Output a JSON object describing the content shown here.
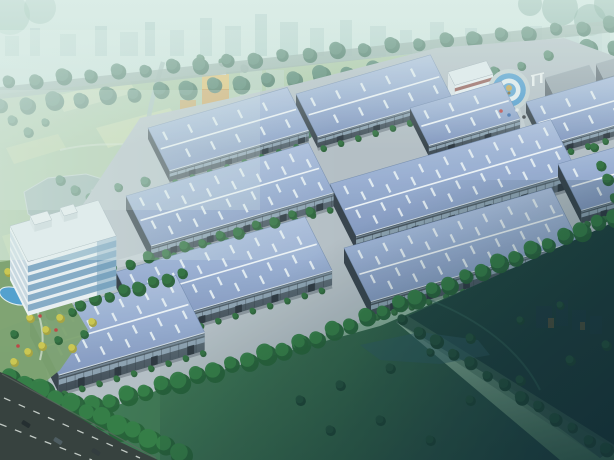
{
  "meta": {
    "width": 614,
    "height": 460,
    "scene_title": "aerial-rendering-of-industrial-park"
  },
  "colors": {
    "sky_top": "#d9ece6",
    "sky_mid": "#c6ded6",
    "haze_green": "#a7c8b4",
    "ground_green": "#47785c",
    "skyline": "#9fc3bc",
    "haze_white": "#e4f2ee",
    "dark_corner": "#08222c",
    "park_base": "#a9c59b",
    "lake": "#97aeac",
    "lake_edge": "#c6d4d0",
    "river": "#a3bcb8",
    "back_road": "#95aca4",
    "fence": "#d6ded9",
    "roof_light": "#b7c6e3",
    "roof_mid": "#9cb0d5",
    "roof_dark": "#8296c0",
    "ridge": "#f2f6fa",
    "skylight": "#eaf1f7",
    "roof_edge": "#6d84ab",
    "wall_light": "#5a6874",
    "wall_dark": "#39434e",
    "gable": "#323c46",
    "window_strip": "#94a8ba",
    "door": "#252e37",
    "eave": "#dfe7ee",
    "pavement": "#b6bfc6",
    "inner_road": "#c9d1d6",
    "lawn_light": "#3f7a52",
    "lawn_mid": "#2c5f44",
    "lawn_dark": "#16383a",
    "rpark_light": "#1c443a",
    "rpark_dark": "#0d2830",
    "office_white": "#eef3f6",
    "office_side": "#f4f7f9",
    "office_glass": "#7ea6c4",
    "office_roof": "#e7edf1",
    "accent_red": "#8e4a44",
    "dorm_front": "#77818c",
    "dorm_side": "#5d6670",
    "dorm_roof": "#9aa4ad",
    "dorm_win": "#49525c",
    "tower_orange": "#d49a46",
    "tower_orange_hi": "#e7c06a",
    "plaza_gray": "#c7d2d4",
    "plaza_blue": "#4f9cd2",
    "plaza_white": "#e8eff2",
    "gold": "#c9a44a",
    "asphalt": "#303836",
    "lane": "#dfe5e0",
    "pool_blue": "#4f9fd0",
    "garden_base": "#7ba06b"
  },
  "scene": {
    "axes": {
      "u": [
        0.96,
        -0.28
      ],
      "v": [
        0.45,
        0.893
      ]
    },
    "skyline": [
      [
        5,
        14,
        20,
        0.5
      ],
      [
        30,
        10,
        28,
        0.45
      ],
      [
        60,
        16,
        22,
        0.5
      ],
      [
        95,
        12,
        30,
        0.55
      ],
      [
        120,
        18,
        24,
        0.5
      ],
      [
        145,
        10,
        34,
        0.6
      ],
      [
        170,
        14,
        26,
        0.5
      ],
      [
        200,
        12,
        38,
        0.55
      ],
      [
        225,
        16,
        30,
        0.5
      ],
      [
        255,
        12,
        42,
        0.6
      ],
      [
        280,
        18,
        34,
        0.55
      ],
      [
        310,
        14,
        28,
        0.5
      ],
      [
        340,
        12,
        36,
        0.55
      ],
      [
        370,
        16,
        30,
        0.5
      ],
      [
        400,
        12,
        26,
        0.45
      ],
      [
        430,
        14,
        34,
        0.5
      ],
      [
        465,
        12,
        28,
        0.45
      ],
      [
        495,
        16,
        24,
        0.4
      ],
      [
        530,
        12,
        30,
        0.45
      ],
      [
        565,
        14,
        22,
        0.4
      ],
      [
        590,
        12,
        26,
        0.4
      ]
    ],
    "park_outline": [
      [
        0,
        94
      ],
      [
        560,
        40
      ],
      [
        548,
        58
      ],
      [
        120,
        190
      ],
      [
        94,
        196
      ],
      [
        56,
        256
      ],
      [
        36,
        316
      ],
      [
        0,
        330
      ]
    ],
    "lake": [
      [
        24,
        192
      ],
      [
        48,
        178
      ],
      [
        86,
        174
      ],
      [
        112,
        182
      ],
      [
        134,
        196
      ],
      [
        138,
        212
      ],
      [
        120,
        226
      ],
      [
        84,
        232
      ],
      [
        50,
        228
      ],
      [
        28,
        214
      ]
    ],
    "fields": [
      {
        "pts": [
          [
            96,
            128
          ],
          [
            170,
            108
          ],
          [
            182,
            126
          ],
          [
            108,
            148
          ]
        ],
        "c": "#c9dba8",
        "o": 0.85
      },
      {
        "pts": [
          [
            152,
            158
          ],
          [
            228,
            138
          ],
          [
            240,
            156
          ],
          [
            164,
            178
          ]
        ],
        "c": "#b7cf96",
        "o": 0.8
      },
      {
        "pts": [
          [
            56,
            96
          ],
          [
            128,
            78
          ],
          [
            136,
            92
          ],
          [
            64,
            112
          ]
        ],
        "c": "#d2e0b2",
        "o": 0.7
      },
      {
        "pts": [
          [
            6,
            148
          ],
          [
            58,
            134
          ],
          [
            66,
            148
          ],
          [
            14,
            164
          ]
        ],
        "c": "#c3d6a4",
        "o": 0.8
      },
      {
        "pts": [
          [
            2,
            236
          ],
          [
            44,
            224
          ],
          [
            54,
            240
          ],
          [
            10,
            258
          ]
        ],
        "c": "#bdd3a0",
        "o": 0.8
      }
    ],
    "park_trees": [
      [
        12,
        120,
        5
      ],
      [
        28,
        132,
        5
      ],
      [
        45,
        122,
        4
      ],
      [
        160,
        120,
        5
      ],
      [
        175,
        132,
        5
      ],
      [
        190,
        142,
        5
      ],
      [
        205,
        152,
        5
      ],
      [
        60,
        180,
        5
      ],
      [
        75,
        190,
        5
      ],
      [
        90,
        198,
        5
      ],
      [
        105,
        206,
        5
      ],
      [
        250,
        120,
        4
      ],
      [
        265,
        128,
        4
      ],
      [
        282,
        134,
        4
      ],
      [
        300,
        140,
        4
      ],
      [
        320,
        128,
        4
      ],
      [
        140,
        200,
        5
      ],
      [
        155,
        210,
        5
      ],
      [
        240,
        160,
        5
      ],
      [
        255,
        168,
        5
      ],
      [
        270,
        176,
        4
      ],
      [
        200,
        58,
        4
      ],
      [
        222,
        62,
        4
      ],
      [
        244,
        68,
        4
      ]
    ],
    "tower": {
      "x": 202,
      "y": 74,
      "w": 27,
      "h": 50,
      "subs": [
        [
          180,
          100,
          16,
          24
        ],
        [
          196,
          106,
          13,
          20
        ]
      ]
    },
    "hazy_towers": [
      [
        240,
        62,
        22,
        46,
        0.45
      ],
      [
        266,
        70,
        18,
        40,
        0.4
      ],
      [
        300,
        92,
        34,
        22,
        0.5
      ],
      [
        344,
        88,
        26,
        24,
        0.4
      ],
      [
        566,
        34,
        16,
        28,
        0.5
      ],
      [
        588,
        26,
        22,
        36,
        0.55
      ]
    ],
    "back_road_band": [
      [
        0,
        99
      ],
      [
        614,
        32
      ],
      [
        614,
        20
      ],
      [
        0,
        87
      ]
    ],
    "fence": {
      "from": [
        92,
        192
      ],
      "to": [
        560,
        40
      ]
    },
    "pavement": [
      [
        78,
        212
      ],
      [
        140,
        118
      ],
      [
        296,
        84
      ],
      [
        436,
        48
      ],
      [
        564,
        38
      ],
      [
        614,
        56
      ],
      [
        614,
        248
      ],
      [
        420,
        300
      ],
      [
        240,
        368
      ],
      [
        120,
        420
      ],
      [
        52,
        398
      ],
      [
        38,
        330
      ],
      [
        58,
        254
      ]
    ],
    "inner_roads": [
      {
        "pts": [
          [
            100,
            265
          ],
          [
            318,
            203
          ],
          [
            322,
            210
          ],
          [
            104,
            272
          ]
        ]
      },
      {
        "pts": [
          [
            36,
            320
          ],
          [
            184,
            272
          ],
          [
            188,
            279
          ],
          [
            40,
            327
          ]
        ]
      },
      {
        "pts": [
          [
            502,
            114
          ],
          [
            520,
            108
          ],
          [
            538,
            170
          ],
          [
            518,
            176
          ]
        ]
      }
    ],
    "warehouses": [
      {
        "name": "warehouse-back-left",
        "x": 148,
        "y": 128,
        "l": 145,
        "w": 48,
        "h": 11
      },
      {
        "name": "warehouse-back-center",
        "x": 296,
        "y": 94,
        "l": 140,
        "w": 48,
        "h": 11
      },
      {
        "name": "warehouse-back-right",
        "x": 410,
        "y": 108,
        "l": 95,
        "w": 42,
        "h": 11
      },
      {
        "name": "warehouse-far-right",
        "x": 526,
        "y": 102,
        "l": 130,
        "w": 48,
        "h": 11
      },
      {
        "name": "warehouse-mid-right",
        "x": 330,
        "y": 184,
        "l": 230,
        "w": 58,
        "h": 15
      },
      {
        "name": "warehouse-right-edge",
        "x": 558,
        "y": 164,
        "l": 120,
        "w": 52,
        "h": 13
      },
      {
        "name": "warehouse-mid-left",
        "x": 126,
        "y": 196,
        "l": 190,
        "w": 56,
        "h": 14
      },
      {
        "name": "warehouse-front-right",
        "x": 344,
        "y": 248,
        "l": 216,
        "w": 60,
        "h": 15
      },
      {
        "name": "warehouse-front-left",
        "x": 116,
        "y": 272,
        "l": 197,
        "w": 60,
        "h": 15
      },
      {
        "name": "warehouse-foreground",
        "x": 30,
        "y": 318,
        "l": 152,
        "w": 64,
        "h": 18
      }
    ],
    "hq_office": {
      "x": 10,
      "y": 226,
      "l": 92,
      "w": 40,
      "h": 54
    },
    "top_office": {
      "x": 448,
      "y": 72,
      "l": 40,
      "w": 15,
      "h": 24
    },
    "dorms": [
      {
        "x": 545,
        "y": 78,
        "l": 46,
        "w": 18,
        "h": 40
      },
      {
        "x": 596,
        "y": 64,
        "l": 30,
        "w": 16,
        "h": 36
      }
    ],
    "plaza": {
      "cx": 509,
      "cy": 90,
      "r": 21
    },
    "plaza_dots": [
      [
        501,
        111,
        "#c04848"
      ],
      [
        509,
        115,
        "#3f6fae"
      ],
      [
        517,
        110,
        "#e6e9ea"
      ],
      [
        524,
        117,
        "#3a3f44"
      ]
    ],
    "garden": {
      "outline": [
        [
          0,
          262
        ],
        [
          26,
          258
        ],
        [
          70,
          300
        ],
        [
          88,
          330
        ],
        [
          60,
          370
        ],
        [
          20,
          402
        ],
        [
          0,
          404
        ]
      ],
      "pool": {
        "cx": 15,
        "cy": 296,
        "rx": 16,
        "ry": 8
      },
      "yellow_trees": [
        [
          8,
          272
        ],
        [
          22,
          282
        ],
        [
          36,
          292
        ],
        [
          50,
          304
        ],
        [
          30,
          318
        ],
        [
          14,
          334
        ],
        [
          46,
          330
        ],
        [
          60,
          318
        ],
        [
          72,
          312
        ],
        [
          28,
          352
        ],
        [
          42,
          346
        ],
        [
          58,
          340
        ],
        [
          14,
          362
        ],
        [
          72,
          348
        ],
        [
          84,
          334
        ],
        [
          92,
          322
        ]
      ],
      "red_dots": [
        [
          24,
          300
        ],
        [
          40,
          316
        ],
        [
          56,
          330
        ],
        [
          18,
          346
        ]
      ]
    },
    "lawn_main": [
      [
        50,
        430
      ],
      [
        180,
        382
      ],
      [
        300,
        348
      ],
      [
        380,
        326
      ],
      [
        450,
        296
      ],
      [
        520,
        266
      ],
      [
        614,
        222
      ],
      [
        614,
        448
      ],
      [
        600,
        458
      ],
      [
        408,
        316
      ],
      [
        396,
        322
      ],
      [
        560,
        460
      ],
      [
        150,
        460
      ]
    ],
    "rpark": [
      [
        396,
        322
      ],
      [
        408,
        316
      ],
      [
        614,
        222
      ],
      [
        614,
        448
      ]
    ],
    "park_road": [
      [
        396,
        322
      ],
      [
        408,
        316
      ],
      [
        616,
        446
      ],
      [
        600,
        458
      ]
    ],
    "rpark_lake": [
      [
        360,
        345
      ],
      [
        420,
        332
      ],
      [
        478,
        340
      ],
      [
        490,
        355
      ],
      [
        440,
        364
      ],
      [
        380,
        360
      ]
    ],
    "silhouettes": [
      [
        536,
        306,
        16,
        22
      ],
      [
        556,
        300,
        12,
        26
      ],
      [
        572,
        310,
        14,
        20
      ],
      [
        590,
        316,
        12,
        18
      ]
    ],
    "silhouette_hints": [
      [
        548,
        318,
        6,
        10
      ],
      [
        580,
        322,
        5,
        8
      ]
    ],
    "road": {
      "outline": [
        [
          0,
          372
        ],
        [
          10,
          376
        ],
        [
          60,
          406
        ],
        [
          120,
          442
        ],
        [
          158,
          460
        ],
        [
          0,
          460
        ]
      ],
      "dashes": [
        [
          [
            4,
            398
          ],
          [
            140,
            458
          ]
        ],
        [
          [
            0,
            424
          ],
          [
            92,
            460
          ]
        ]
      ],
      "cars": [
        [
          26,
          424,
          32,
          "#1d2427"
        ],
        [
          58,
          441,
          32,
          "#49565c"
        ],
        [
          96,
          452,
          32,
          "#2c3336"
        ]
      ]
    },
    "tree_rows": [
      {
        "name": "boulevard-trees-upper",
        "layer": "pre",
        "from": [
          8,
          82
        ],
        "to": [
          610,
          24
        ],
        "spacing": 27,
        "r": 7,
        "palette": "back"
      },
      {
        "name": "boulevard-trees-lower",
        "layer": "pre",
        "from": [
          0,
          106
        ],
        "to": [
          614,
          46
        ],
        "spacing": 26,
        "r": 8,
        "palette": "back"
      },
      {
        "name": "perimeter-trees",
        "layer": "pre",
        "from": [
          118,
          188
        ],
        "to": [
          548,
          56
        ],
        "spacing": 27,
        "r": 5,
        "palette": "park"
      },
      {
        "name": "row-behind-foreground",
        "layer": "post",
        "from": [
          36,
          316
        ],
        "to": [
          182,
          274
        ],
        "spacing": 15,
        "r": 6,
        "palette": "site"
      },
      {
        "name": "row-mid-left",
        "layer": "post",
        "from": [
          112,
          268
        ],
        "to": [
          310,
          210
        ],
        "spacing": 18,
        "r": 5,
        "palette": "site"
      },
      {
        "name": "right-edge-trees",
        "layer": "post",
        "from": [
          594,
          148
        ],
        "to": [
          614,
          196
        ],
        "spacing": 14,
        "r": 5,
        "palette": "site"
      },
      {
        "name": "front-belt-west",
        "layer": "belt",
        "from": [
          58,
          416
        ],
        "to": [
          300,
          344
        ],
        "spacing": 17,
        "r": 9,
        "palette": "front"
      },
      {
        "name": "front-belt-east",
        "layer": "belt",
        "from": [
          300,
          344
        ],
        "to": [
          614,
          216
        ],
        "spacing": 17,
        "r": 8,
        "palette": "front"
      },
      {
        "name": "park-road-trees",
        "layer": "belt",
        "from": [
          402,
          320
        ],
        "to": [
          606,
          450
        ],
        "spacing": 20,
        "r": 6,
        "palette": "dark"
      },
      {
        "name": "roadside-cluster",
        "layer": "belt",
        "from": [
          10,
          378
        ],
        "to": [
          180,
          452
        ],
        "spacing": 16,
        "r": 11,
        "palette": "front"
      }
    ],
    "lawn_trees": [
      [
        300,
        400,
        5
      ],
      [
        340,
        385,
        5
      ],
      [
        390,
        368,
        5
      ],
      [
        430,
        352,
        4
      ],
      [
        470,
        338,
        5
      ],
      [
        520,
        320,
        4
      ],
      [
        560,
        305,
        4
      ],
      [
        470,
        400,
        5
      ],
      [
        520,
        380,
        5
      ],
      [
        570,
        360,
        5
      ],
      [
        606,
        345,
        5
      ],
      [
        380,
        420,
        5
      ],
      [
        430,
        440,
        5
      ],
      [
        330,
        430,
        5
      ]
    ],
    "corner_foliage_tr": [
      [
        560,
        8,
        18
      ],
      [
        590,
        20,
        16
      ],
      [
        612,
        4,
        18
      ],
      [
        530,
        4,
        12
      ]
    ],
    "corner_foliage_tl": [
      [
        10,
        15,
        20
      ],
      [
        40,
        8,
        16
      ]
    ]
  }
}
